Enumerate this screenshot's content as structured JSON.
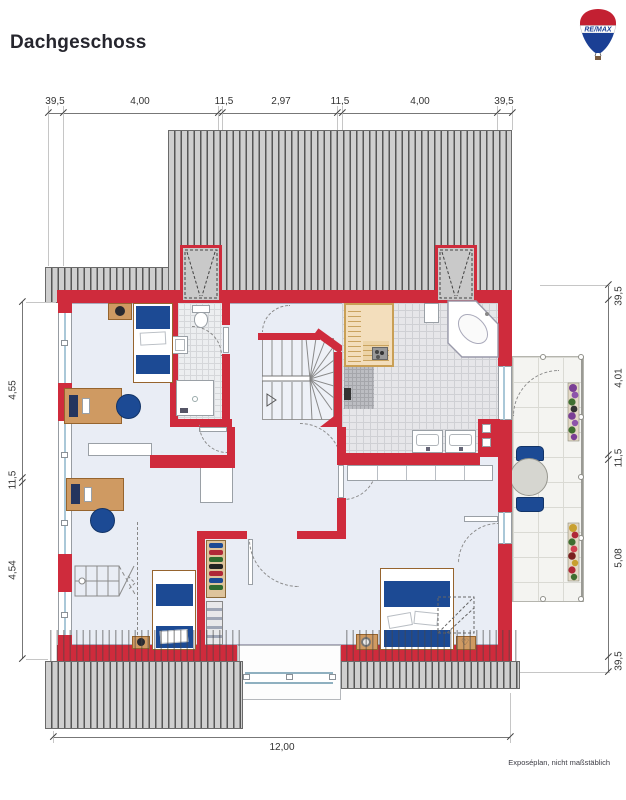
{
  "header": {
    "title": "Dachgeschoss",
    "logo_text": "RE/MAX"
  },
  "dimensions": {
    "top": [
      "39,5",
      "4,00",
      "11,5",
      "2,97",
      "11,5",
      "4,00",
      "39,5"
    ],
    "right": [
      "39,5",
      "4,01",
      "11,5",
      "5,08",
      "39,5"
    ],
    "left": [
      "4,55",
      "11,5",
      "4,54"
    ],
    "bottom": [
      "12,00"
    ]
  },
  "footer": {
    "note": "Exposéplan, nicht maßstäblich"
  },
  "colors": {
    "wall": "#cf2b3c",
    "roof": "#cfcfcf",
    "floor": "#e9edf5",
    "accent_navy": "#1c4a94",
    "wood": "#cf9a62",
    "logo_red": "#c32032",
    "logo_blue": "#1b3f94"
  }
}
